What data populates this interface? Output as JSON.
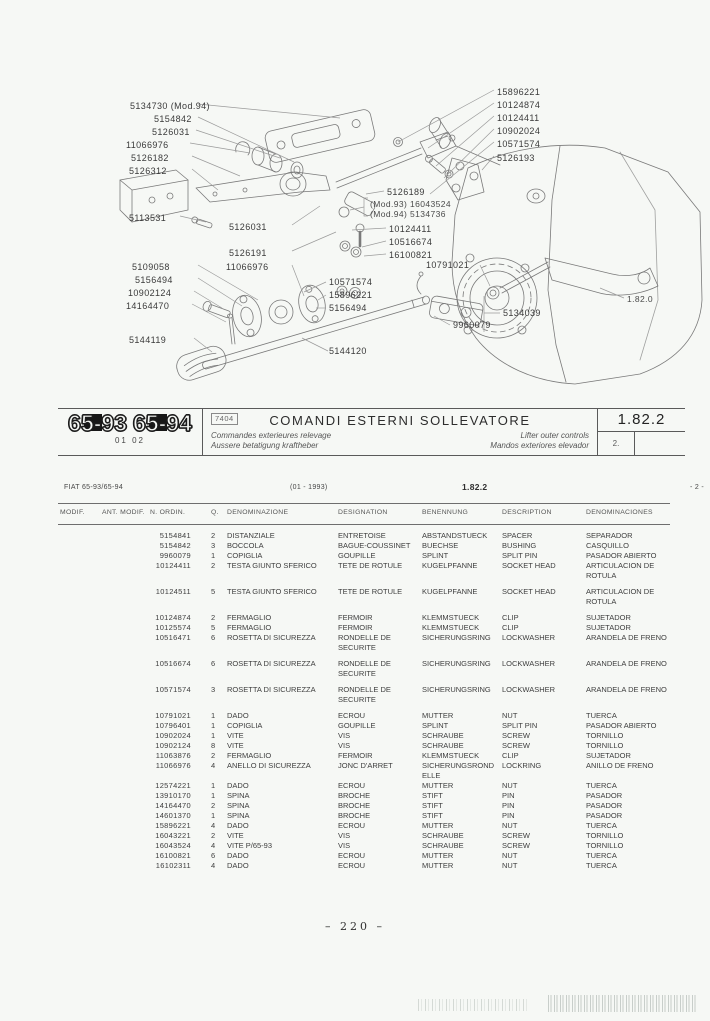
{
  "header": {
    "model_badge_1": "65-93",
    "model_badge_2": "65-94",
    "badge_sub": "01 02",
    "code_box": "7404",
    "title": "COMANDI ESTERNI SOLLEVATORE",
    "subtitle_fr": "Commandes exterieures relevage",
    "subtitle_de": "Aussere betatigung kraftheber",
    "subtitle_en": "Lifter outer controls",
    "subtitle_es": "Mandos exteriores elevador",
    "section_code": "1.82.2",
    "sheet_number": "2."
  },
  "diagram": {
    "labels": [
      "5134730 (Mod.94)",
      "5154842",
      "5126031",
      "11066976",
      "5126182",
      "5126312",
      "5113531",
      "5126031",
      "5126191",
      "5109058",
      "11066976",
      "5156494",
      "10902124",
      "14164470",
      "5144119",
      "5144120",
      "15896221",
      "10124874",
      "10124411",
      "10902024",
      "10571574",
      "5126193",
      "5126189",
      "(Mod.93) 16043524",
      "(Mod.94) 5134736",
      "10124411",
      "10516674",
      "16100821",
      "10791021",
      "10571574",
      "15896221",
      "5156494",
      "5134039",
      "9960079",
      "1.82.0"
    ]
  },
  "table_meta": {
    "model_line": "FIAT 65-93/65-94",
    "date_range": "(01 - 1993)",
    "section_code": "1.82.2",
    "page_ref": "- 2 -"
  },
  "table": {
    "columns": [
      "MODIF.",
      "ANT. MODIF.",
      "N. ORDIN.",
      "Q.",
      "DENOMINAZIONE",
      "DESIGNATION",
      "BENENNUNG",
      "DESCRIPTION",
      "DENOMINACIONES"
    ],
    "rows": [
      {
        "ordin": "5154841",
        "qty": "2",
        "den": "DISTANZIALE",
        "des": "ENTRETOISE",
        "ben": "ABSTANDSTUECK",
        "descr": "SPACER",
        "denomin": "SEPARADOR"
      },
      {
        "ordin": "5154842",
        "qty": "3",
        "den": "BOCCOLA",
        "des": "BAGUE-COUSSINET",
        "ben": "BUECHSE",
        "descr": "BUSHING",
        "denomin": "CASQUILLO"
      },
      {
        "ordin": "9960079",
        "qty": "1",
        "den": "COPIGLIA",
        "des": "GOUPILLE",
        "ben": "SPLINT",
        "descr": "SPLIT PIN",
        "denomin": "PASADOR ABIERTO"
      },
      {
        "ordin": "10124411",
        "qty": "2",
        "den": "TESTA GIUNTO SFERICO",
        "des": "TETE DE ROTULE",
        "ben": "KUGELPFANNE",
        "descr": "SOCKET HEAD",
        "denomin": "ARTICULACION DE ROTULA"
      },
      {
        "ordin": "10124511",
        "qty": "5",
        "den": "TESTA GIUNTO SFERICO",
        "des": "TETE DE ROTULE",
        "ben": "KUGELPFANNE",
        "descr": "SOCKET HEAD",
        "denomin": "ARTICULACION DE ROTULA",
        "gap_before": true
      },
      {
        "ordin": "10124874",
        "qty": "2",
        "den": "FERMAGLIO",
        "des": "FERMOIR",
        "ben": "KLEMMSTUECK",
        "descr": "CLIP",
        "denomin": "SUJETADOR",
        "gap_before": true
      },
      {
        "ordin": "10125574",
        "qty": "5",
        "den": "FERMAGLIO",
        "des": "FERMOIR",
        "ben": "KLEMMSTUECK",
        "descr": "CLIP",
        "denomin": "SUJETADOR"
      },
      {
        "ordin": "10516471",
        "qty": "6",
        "den": "ROSETTA DI SICUREZZA",
        "des": "RONDELLE DE SECURITE",
        "ben": "SICHERUNGSRING",
        "descr": "LOCKWASHER",
        "denomin": "ARANDELA DE FRENO"
      },
      {
        "ordin": "10516674",
        "qty": "6",
        "den": "ROSETTA DI SICUREZZA",
        "des": "RONDELLE DE SECURITE",
        "ben": "SICHERUNGSRING",
        "descr": "LOCKWASHER",
        "denomin": "ARANDELA DE FRENO",
        "gap_before": true
      },
      {
        "ordin": "10571574",
        "qty": "3",
        "den": "ROSETTA DI SICUREZZA",
        "des": "RONDELLE DE SECURITE",
        "ben": "SICHERUNGSRING",
        "descr": "LOCKWASHER",
        "denomin": "ARANDELA DE FRENO",
        "gap_before": true
      },
      {
        "ordin": "10791021",
        "qty": "1",
        "den": "DADO",
        "des": "ECROU",
        "ben": "MUTTER",
        "descr": "NUT",
        "denomin": "TUERCA",
        "gap_before": true
      },
      {
        "ordin": "10796401",
        "qty": "1",
        "den": "COPIGLIA",
        "des": "GOUPILLE",
        "ben": "SPLINT",
        "descr": "SPLIT PIN",
        "denomin": "PASADOR ABIERTO"
      },
      {
        "ordin": "10902024",
        "qty": "1",
        "den": "VITE",
        "des": "VIS",
        "ben": "SCHRAUBE",
        "descr": "SCREW",
        "denomin": "TORNILLO"
      },
      {
        "ordin": "10902124",
        "qty": "8",
        "den": "VITE",
        "des": "VIS",
        "ben": "SCHRAUBE",
        "descr": "SCREW",
        "denomin": "TORNILLO"
      },
      {
        "ordin": "11063876",
        "qty": "2",
        "den": "FERMAGLIO",
        "des": "FERMOIR",
        "ben": "KLEMMSTUECK",
        "descr": "CLIP",
        "denomin": "SUJETADOR"
      },
      {
        "ordin": "11066976",
        "qty": "4",
        "den": "ANELLO DI SICUREZZA",
        "des": "JONC D'ARRET",
        "ben": "SICHERUNGSRONDELLE",
        "descr": "LOCKRING",
        "denomin": "ANILLO DE FRENO"
      },
      {
        "ordin": "12574221",
        "qty": "1",
        "den": "DADO",
        "des": "ECROU",
        "ben": "MUTTER",
        "descr": "NUT",
        "denomin": "TUERCA"
      },
      {
        "ordin": "13910170",
        "qty": "1",
        "den": "SPINA",
        "des": "BROCHE",
        "ben": "STIFT",
        "descr": "PIN",
        "denomin": "PASADOR"
      },
      {
        "ordin": "14164470",
        "qty": "2",
        "den": "SPINA",
        "des": "BROCHE",
        "ben": "STIFT",
        "descr": "PIN",
        "denomin": "PASADOR"
      },
      {
        "ordin": "14601370",
        "qty": "1",
        "den": "SPINA",
        "des": "BROCHE",
        "ben": "STIFT",
        "descr": "PIN",
        "denomin": "PASADOR"
      },
      {
        "ordin": "15896221",
        "qty": "4",
        "den": "DADO",
        "des": "ECROU",
        "ben": "MUTTER",
        "descr": "NUT",
        "denomin": "TUERCA"
      },
      {
        "ordin": "16043221",
        "qty": "2",
        "den": "VITE",
        "des": "VIS",
        "ben": "SCHRAUBE",
        "descr": "SCREW",
        "denomin": "TORNILLO"
      },
      {
        "ordin": "16043524",
        "qty": "4",
        "den": "VITE P/65-93",
        "des": "VIS",
        "ben": "SCHRAUBE",
        "descr": "SCREW",
        "denomin": "TORNILLO"
      },
      {
        "ordin": "16100821",
        "qty": "6",
        "den": "DADO",
        "des": "ECROU",
        "ben": "MUTTER",
        "descr": "NUT",
        "denomin": "TUERCA"
      },
      {
        "ordin": "16102311",
        "qty": "4",
        "den": "DADO",
        "des": "ECROU",
        "ben": "MUTTER",
        "descr": "NUT",
        "denomin": "TUERCA"
      }
    ]
  },
  "footer": {
    "page_number": "– 220 –"
  }
}
